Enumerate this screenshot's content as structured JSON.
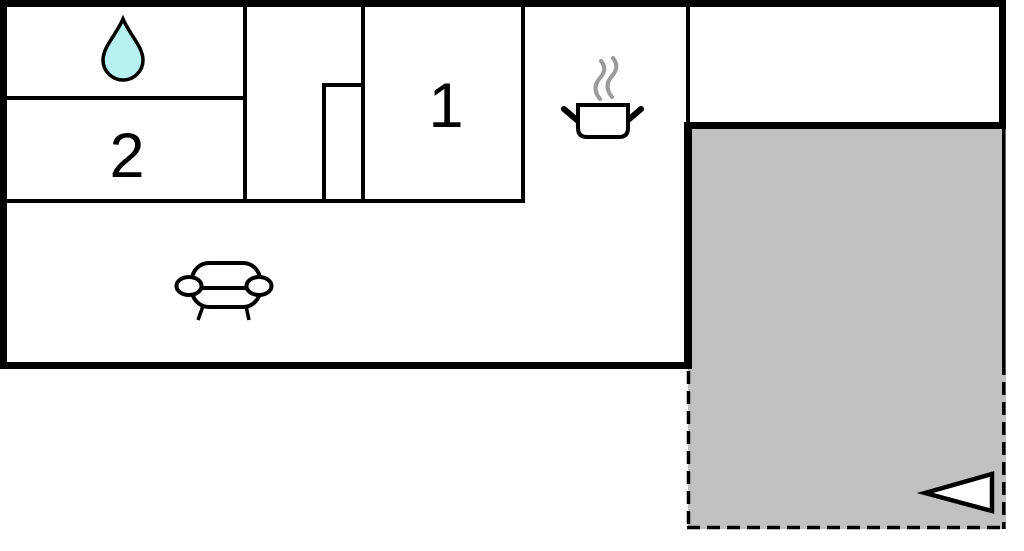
{
  "floorplan": {
    "type": "apartment-floor-plan",
    "room_labels": {
      "bedroom_1": "1",
      "bedroom_2": "2"
    },
    "icons": {
      "bathroom": "water-drop-icon",
      "kitchen": "cooking-pot-icon",
      "kitchen_steam": "steam-icon",
      "living_room": "sofa-icon",
      "terrace_entrance": "entrance-arrow-icon"
    },
    "colors": {
      "walls": "#000000",
      "terrace_fill": "#c1c1c1",
      "water_drop_fill": "#b8f1f1",
      "steam_stroke": "#9b9b9b",
      "icon_fill": "#ffffff",
      "background": "#ffffff"
    }
  }
}
